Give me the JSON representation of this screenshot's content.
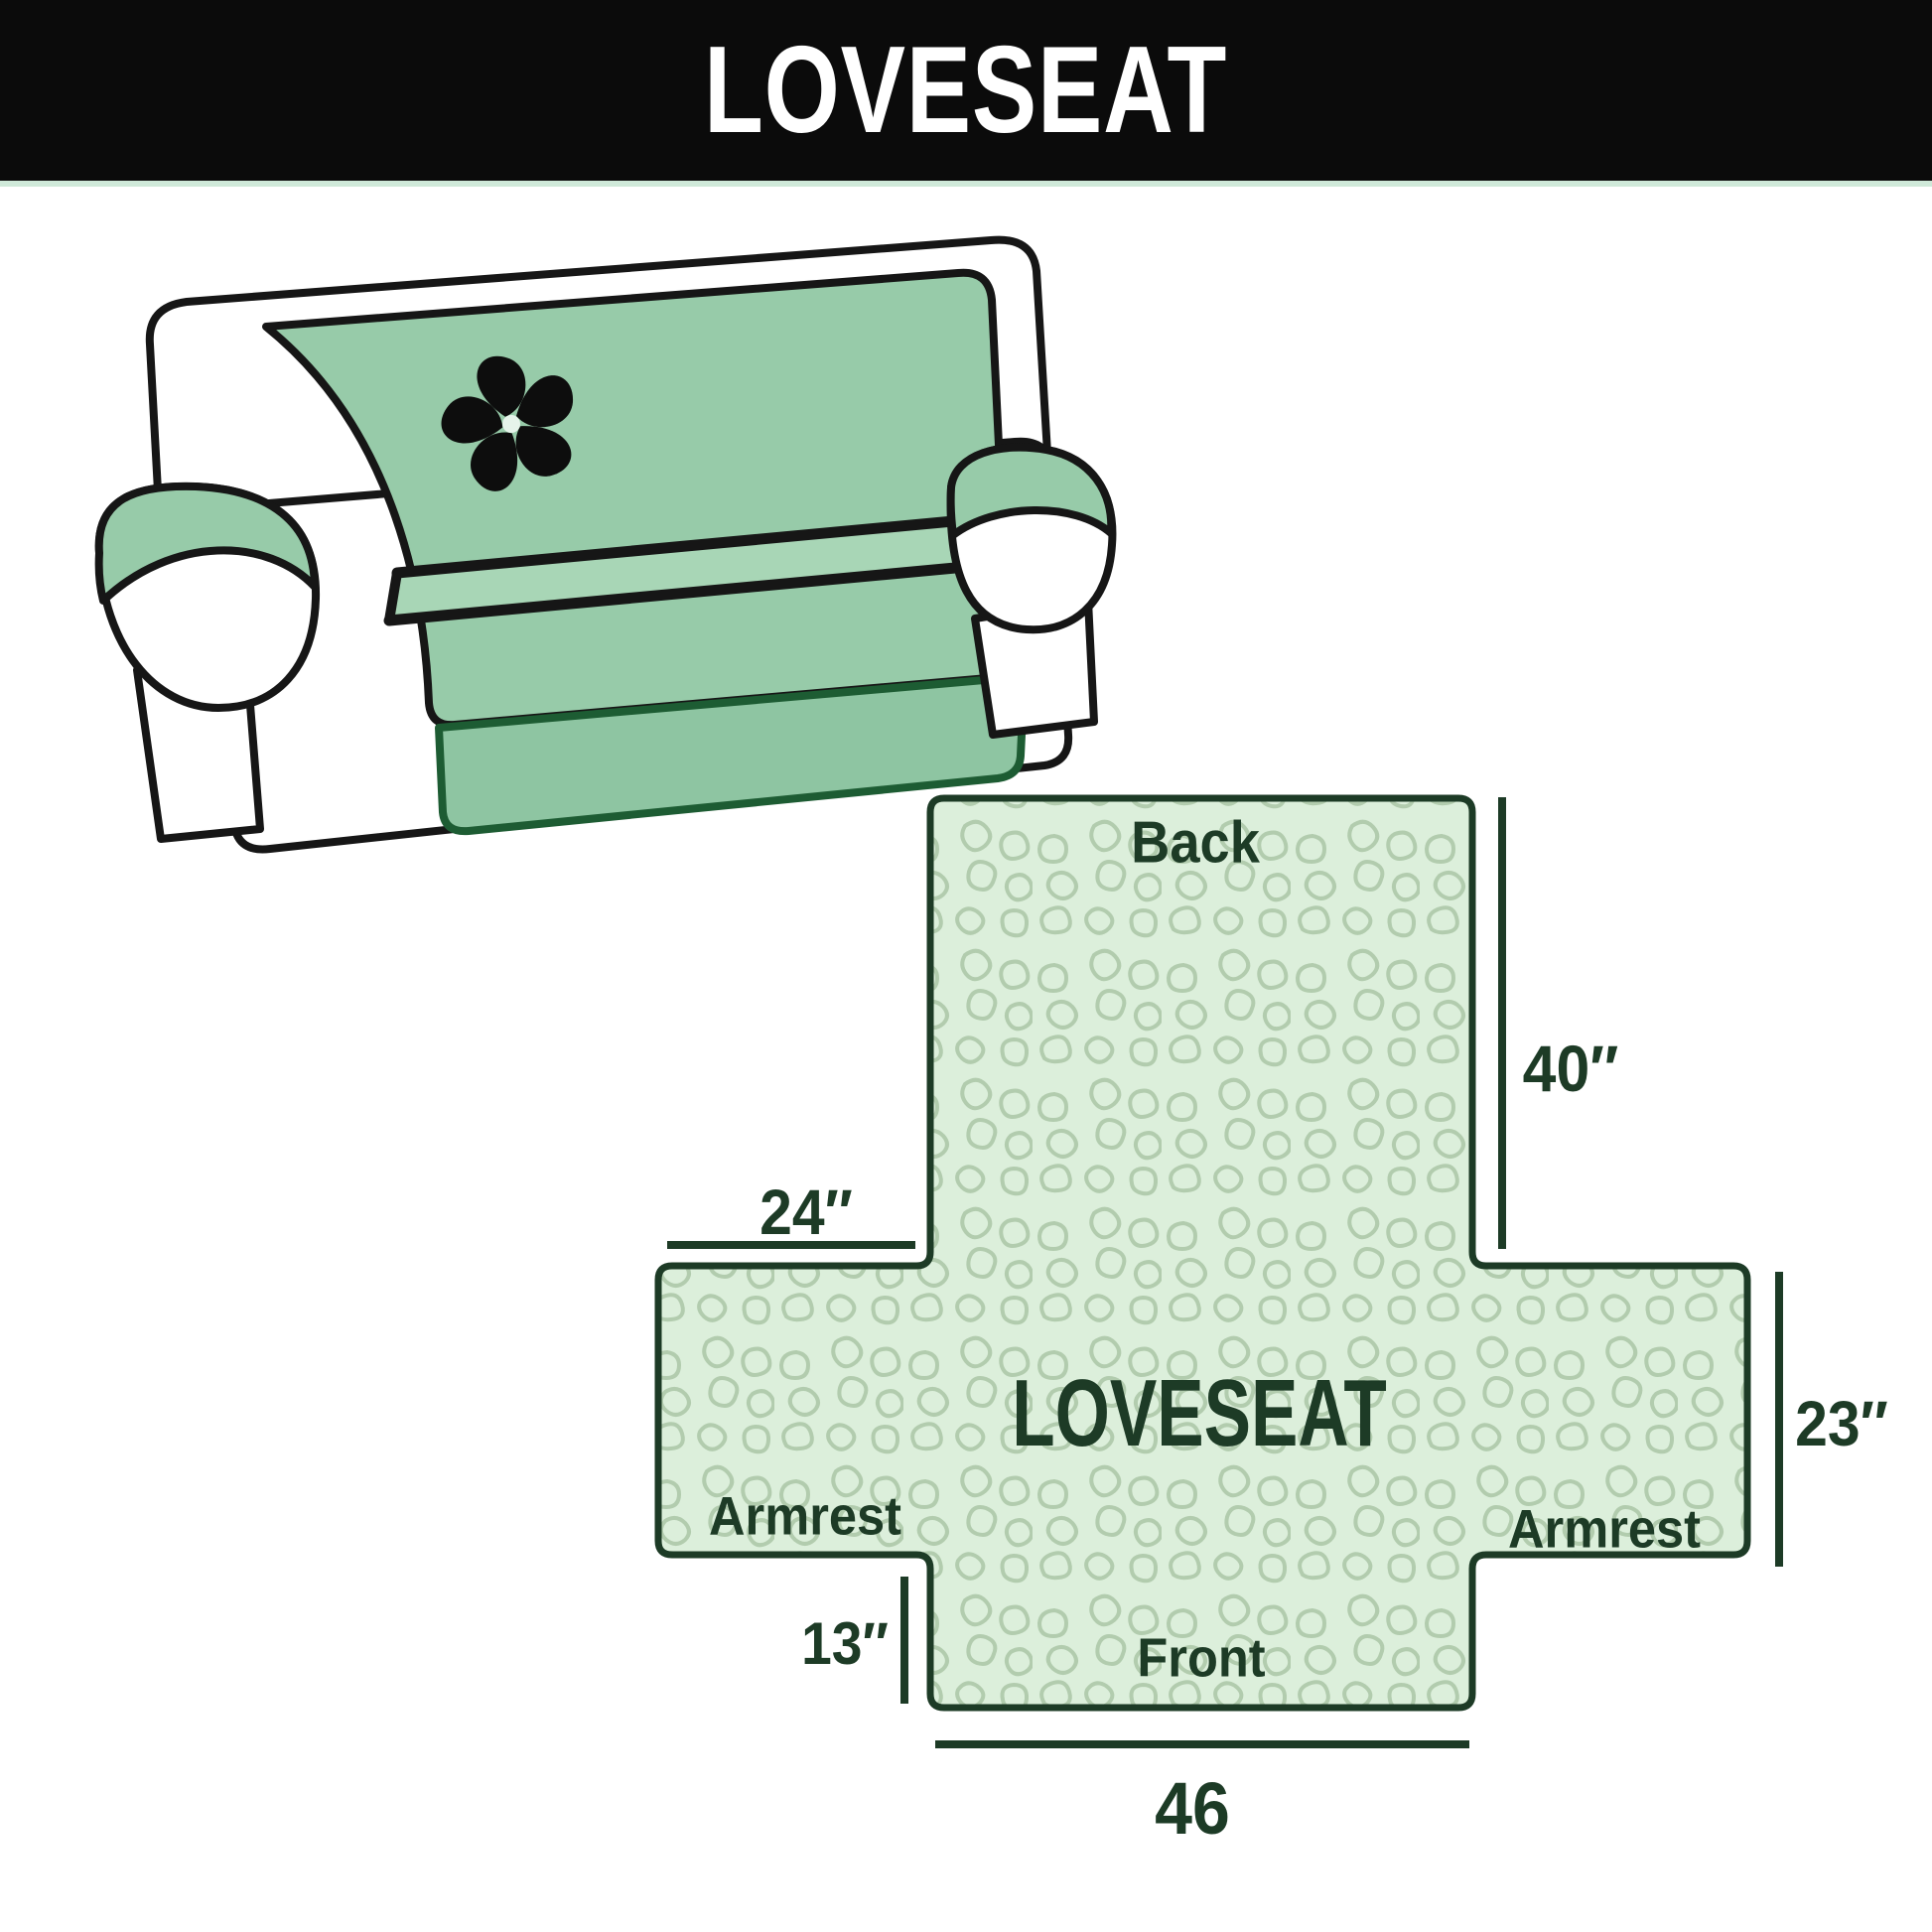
{
  "header": {
    "title": "LOVESEAT",
    "bg_color": "#0b0b0b",
    "text_color": "#ffffff"
  },
  "illustration": {
    "name": "loveseat sofa with slipcover",
    "logo_icon": "pinwheel-fan-icon",
    "cover_color": "#97cba9",
    "outline_color": "#161616"
  },
  "diagram": {
    "labels": {
      "back": "Back",
      "center": "LOVESEAT",
      "armrest_left": "Armrest",
      "armrest_right": "Armrest",
      "front": "Front"
    },
    "dims": {
      "back_height": "40″",
      "armrest_top_width": "24″",
      "armrest_side_height": "23″",
      "front_flap_height": "13″",
      "front_width": "46"
    },
    "dimension_notes": [
      {
        "edge": "back panel height",
        "value": "40″"
      },
      {
        "edge": "armrest top width",
        "value": "24″"
      },
      {
        "edge": "armrest side height",
        "value": "23″"
      },
      {
        "edge": "front flap height",
        "value": "13″"
      },
      {
        "edge": "front flap width",
        "value": "46"
      }
    ],
    "colors": {
      "fill": "#dcefdb",
      "quilt_pattern": "#b2ccae",
      "outline": "#1d3b26",
      "text": "#1d3b26"
    }
  }
}
